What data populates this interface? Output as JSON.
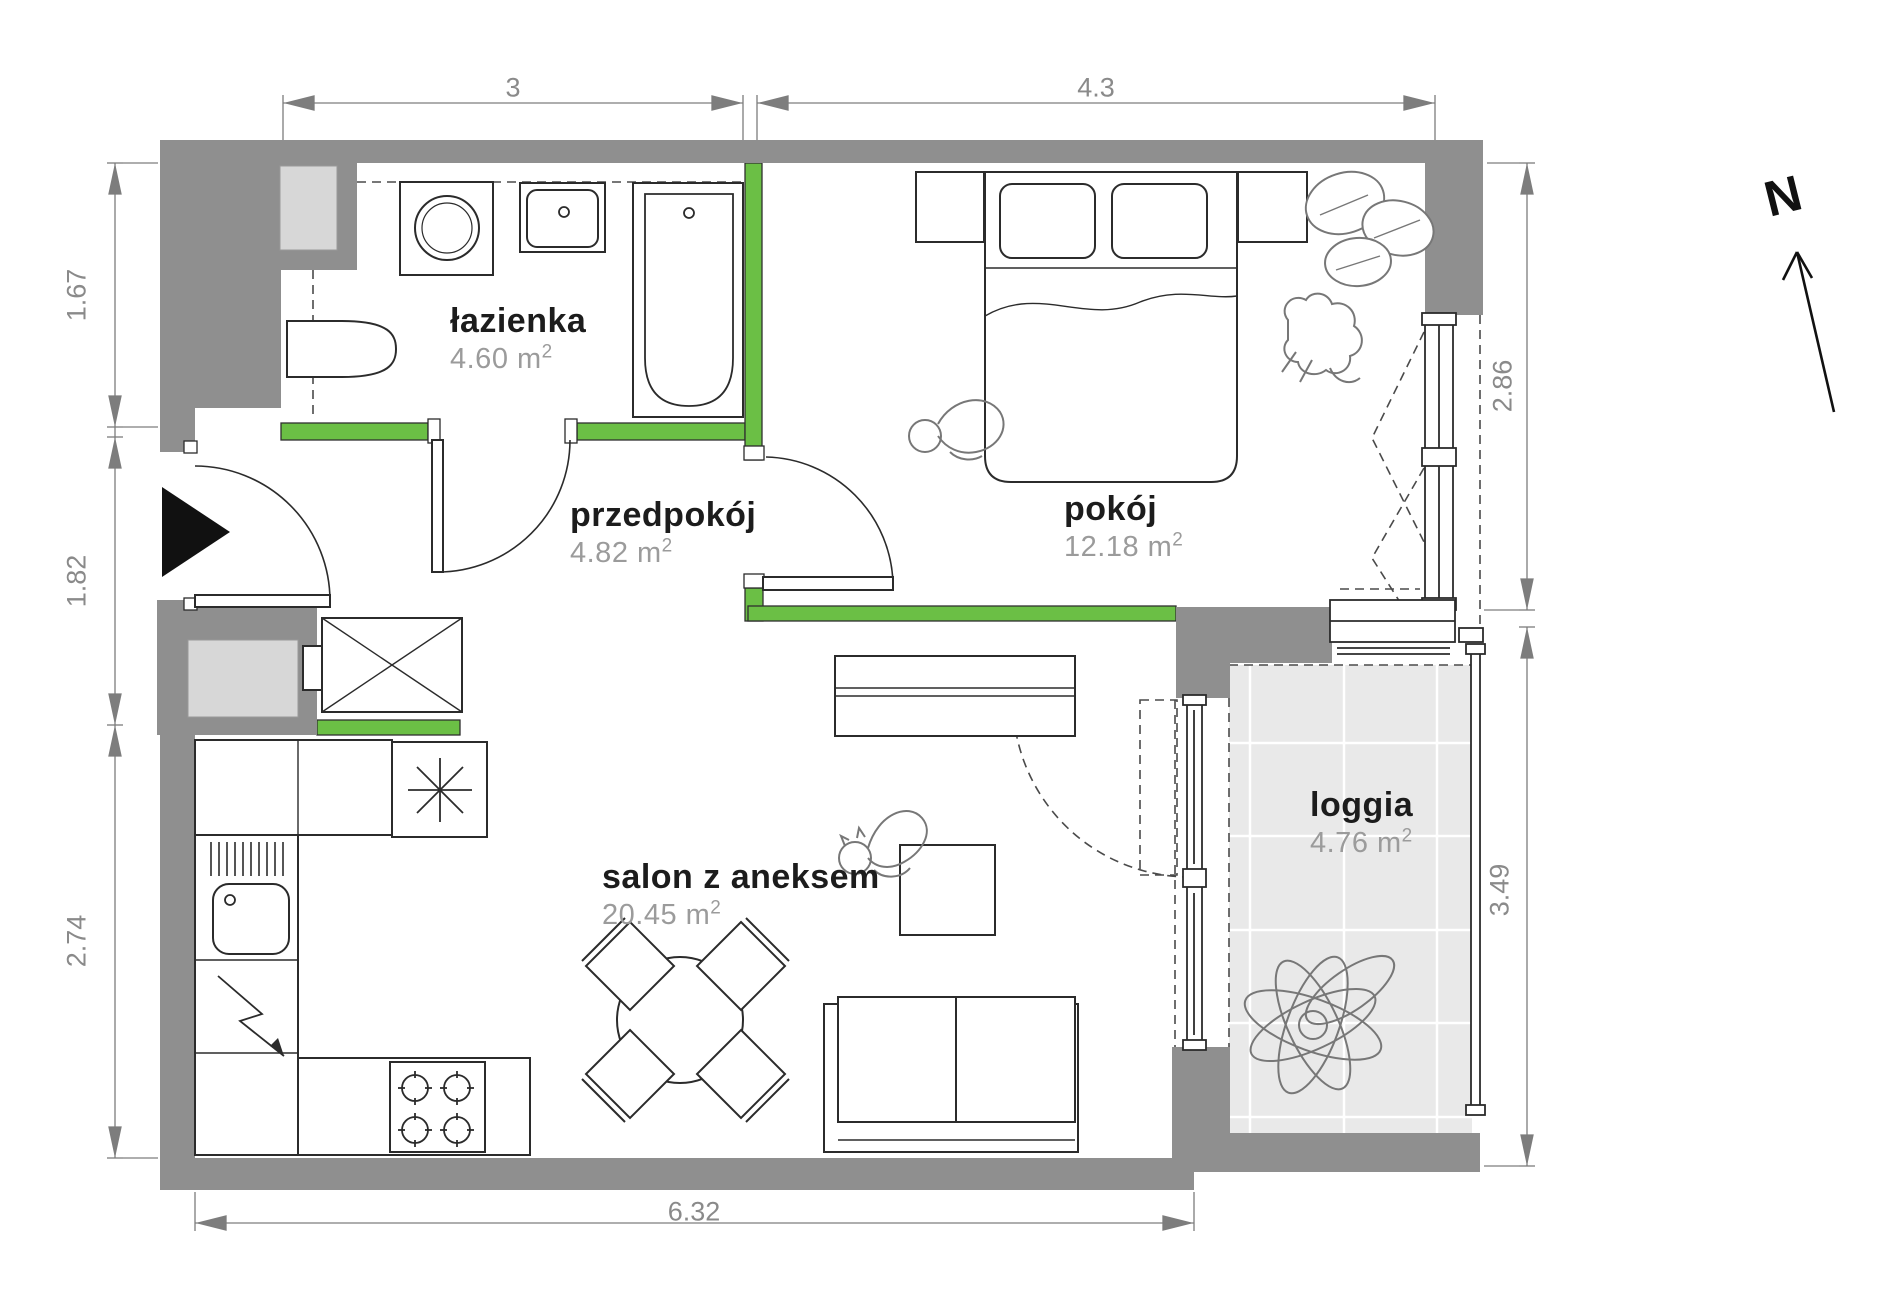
{
  "plan_title": "apartment floor plan",
  "rooms": [
    {
      "id": "lazienka",
      "name": "łazienka",
      "area_base": "4.60 m",
      "area_sup": "2"
    },
    {
      "id": "przedpokoj",
      "name": "przedpokój",
      "area_base": "4.82 m",
      "area_sup": "2"
    },
    {
      "id": "pokoj",
      "name": "pokój",
      "area_base": "12.18 m",
      "area_sup": "2"
    },
    {
      "id": "salon",
      "name": "salon z aneksem",
      "area_base": "20.45 m",
      "area_sup": "2"
    },
    {
      "id": "loggia",
      "name": "loggia",
      "area_base": "4.76 m",
      "area_sup": "2"
    }
  ],
  "dimensions": {
    "top": [
      "3",
      "4.3"
    ],
    "left": [
      "1.67",
      "1.82",
      "2.74"
    ],
    "right": [
      "2.86",
      "3.49"
    ],
    "bottom": [
      "6.32"
    ]
  },
  "compass": {
    "label": "N"
  },
  "colors": {
    "wall": "#8f8f8f",
    "accent_green": "#6bbf45",
    "loggia_floor": "#e9e9e9",
    "shaft_fill": "#d7d7d7",
    "line": "#2b2b2b",
    "label_text": "#1c1c1c",
    "area_text": "#9b9b9b",
    "dim_text": "#8a8a8a"
  }
}
